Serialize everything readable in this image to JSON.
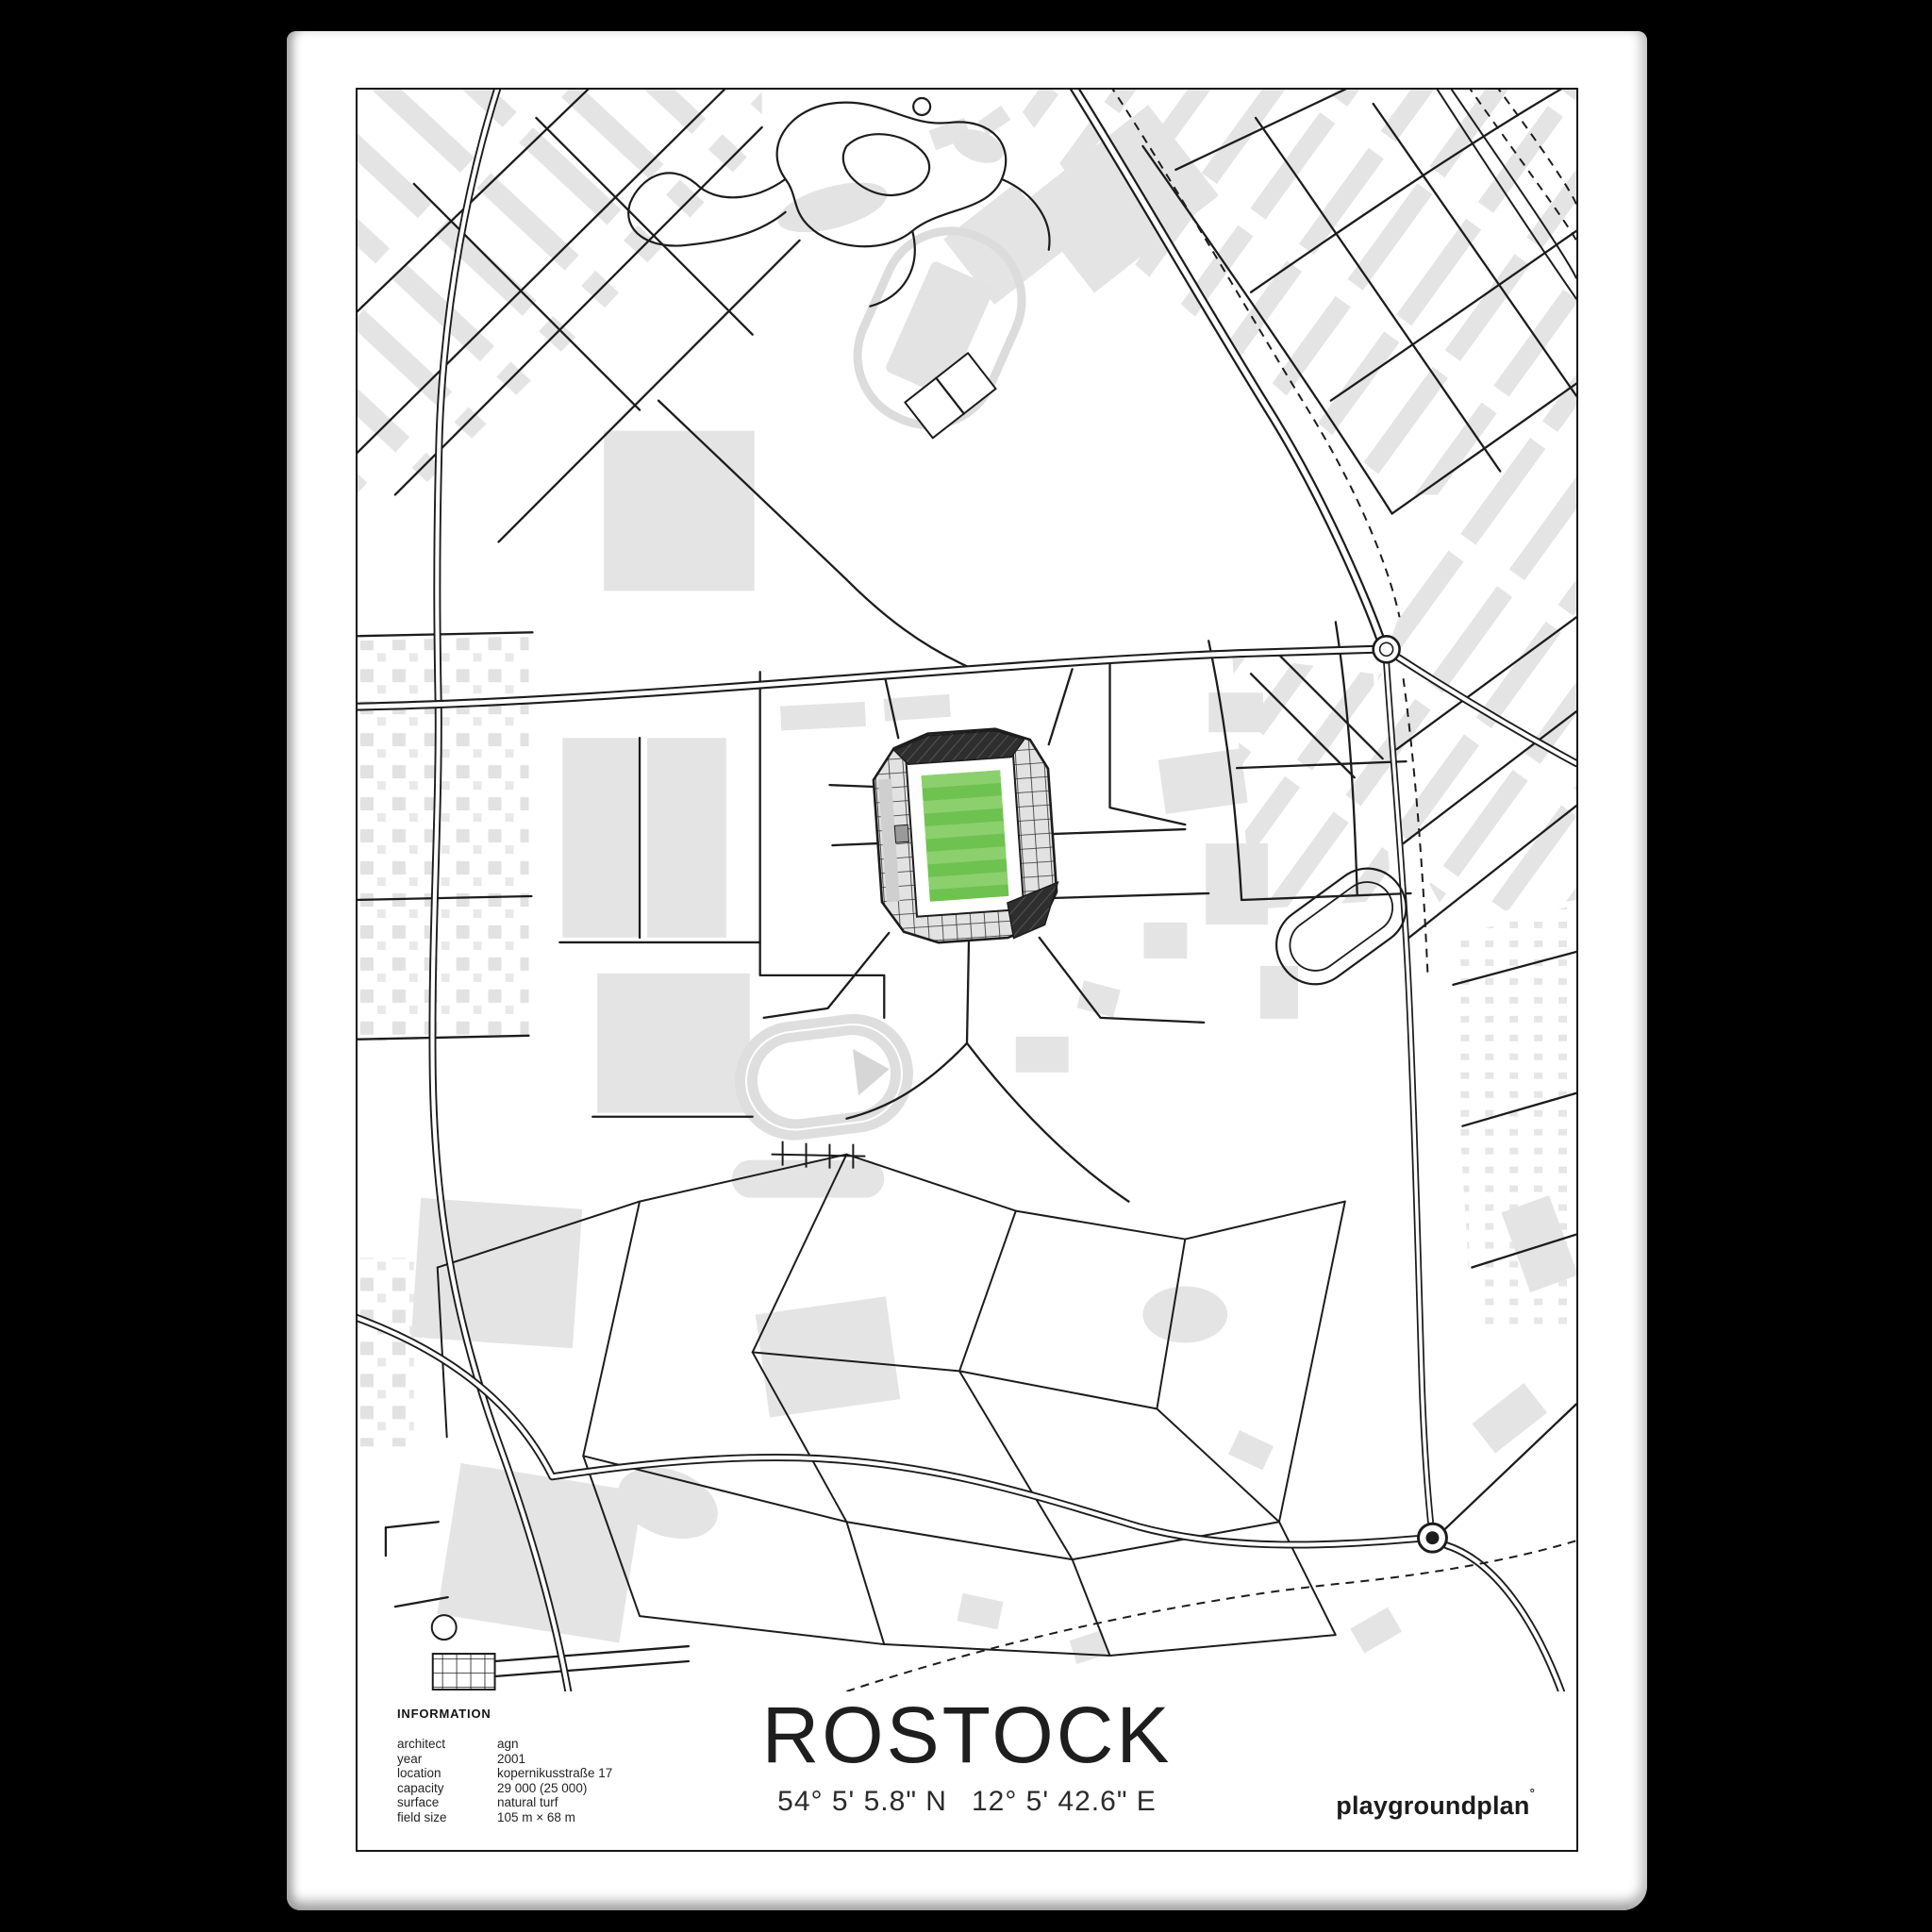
{
  "poster": {
    "title": "ROSTOCK",
    "coordinates": {
      "lat": "54° 5' 5.8\" N",
      "lon": "12° 5' 42.6\" E"
    },
    "brand": {
      "name": "playgroundplan",
      "mark": "°"
    },
    "info": {
      "heading": "INFORMATION",
      "rows": [
        {
          "label": "architect",
          "value": "agn"
        },
        {
          "label": "year",
          "value": "2001"
        },
        {
          "label": "location",
          "value": "kopernikusstraße 17"
        },
        {
          "label": "capacity",
          "value": "29 000 (25 000)"
        },
        {
          "label": "surface",
          "value": "natural turf"
        },
        {
          "label": "field size",
          "value": "105 m × 68 m"
        }
      ]
    }
  },
  "map": {
    "subject": "street map of Rostock with Ostseestadion stadium highlighted",
    "colors": {
      "background": "#000000",
      "paper": "#ffffff",
      "building": "#e4e4e4",
      "road": "#1c1c1c",
      "track_gray": "#dcdcdc",
      "stadium_stand": "#e2e2e2",
      "stadium_dark_stand": "#2e2e2e",
      "pitch_green": "#6ec24f",
      "pitch_green_light": "#8cd06e"
    }
  }
}
